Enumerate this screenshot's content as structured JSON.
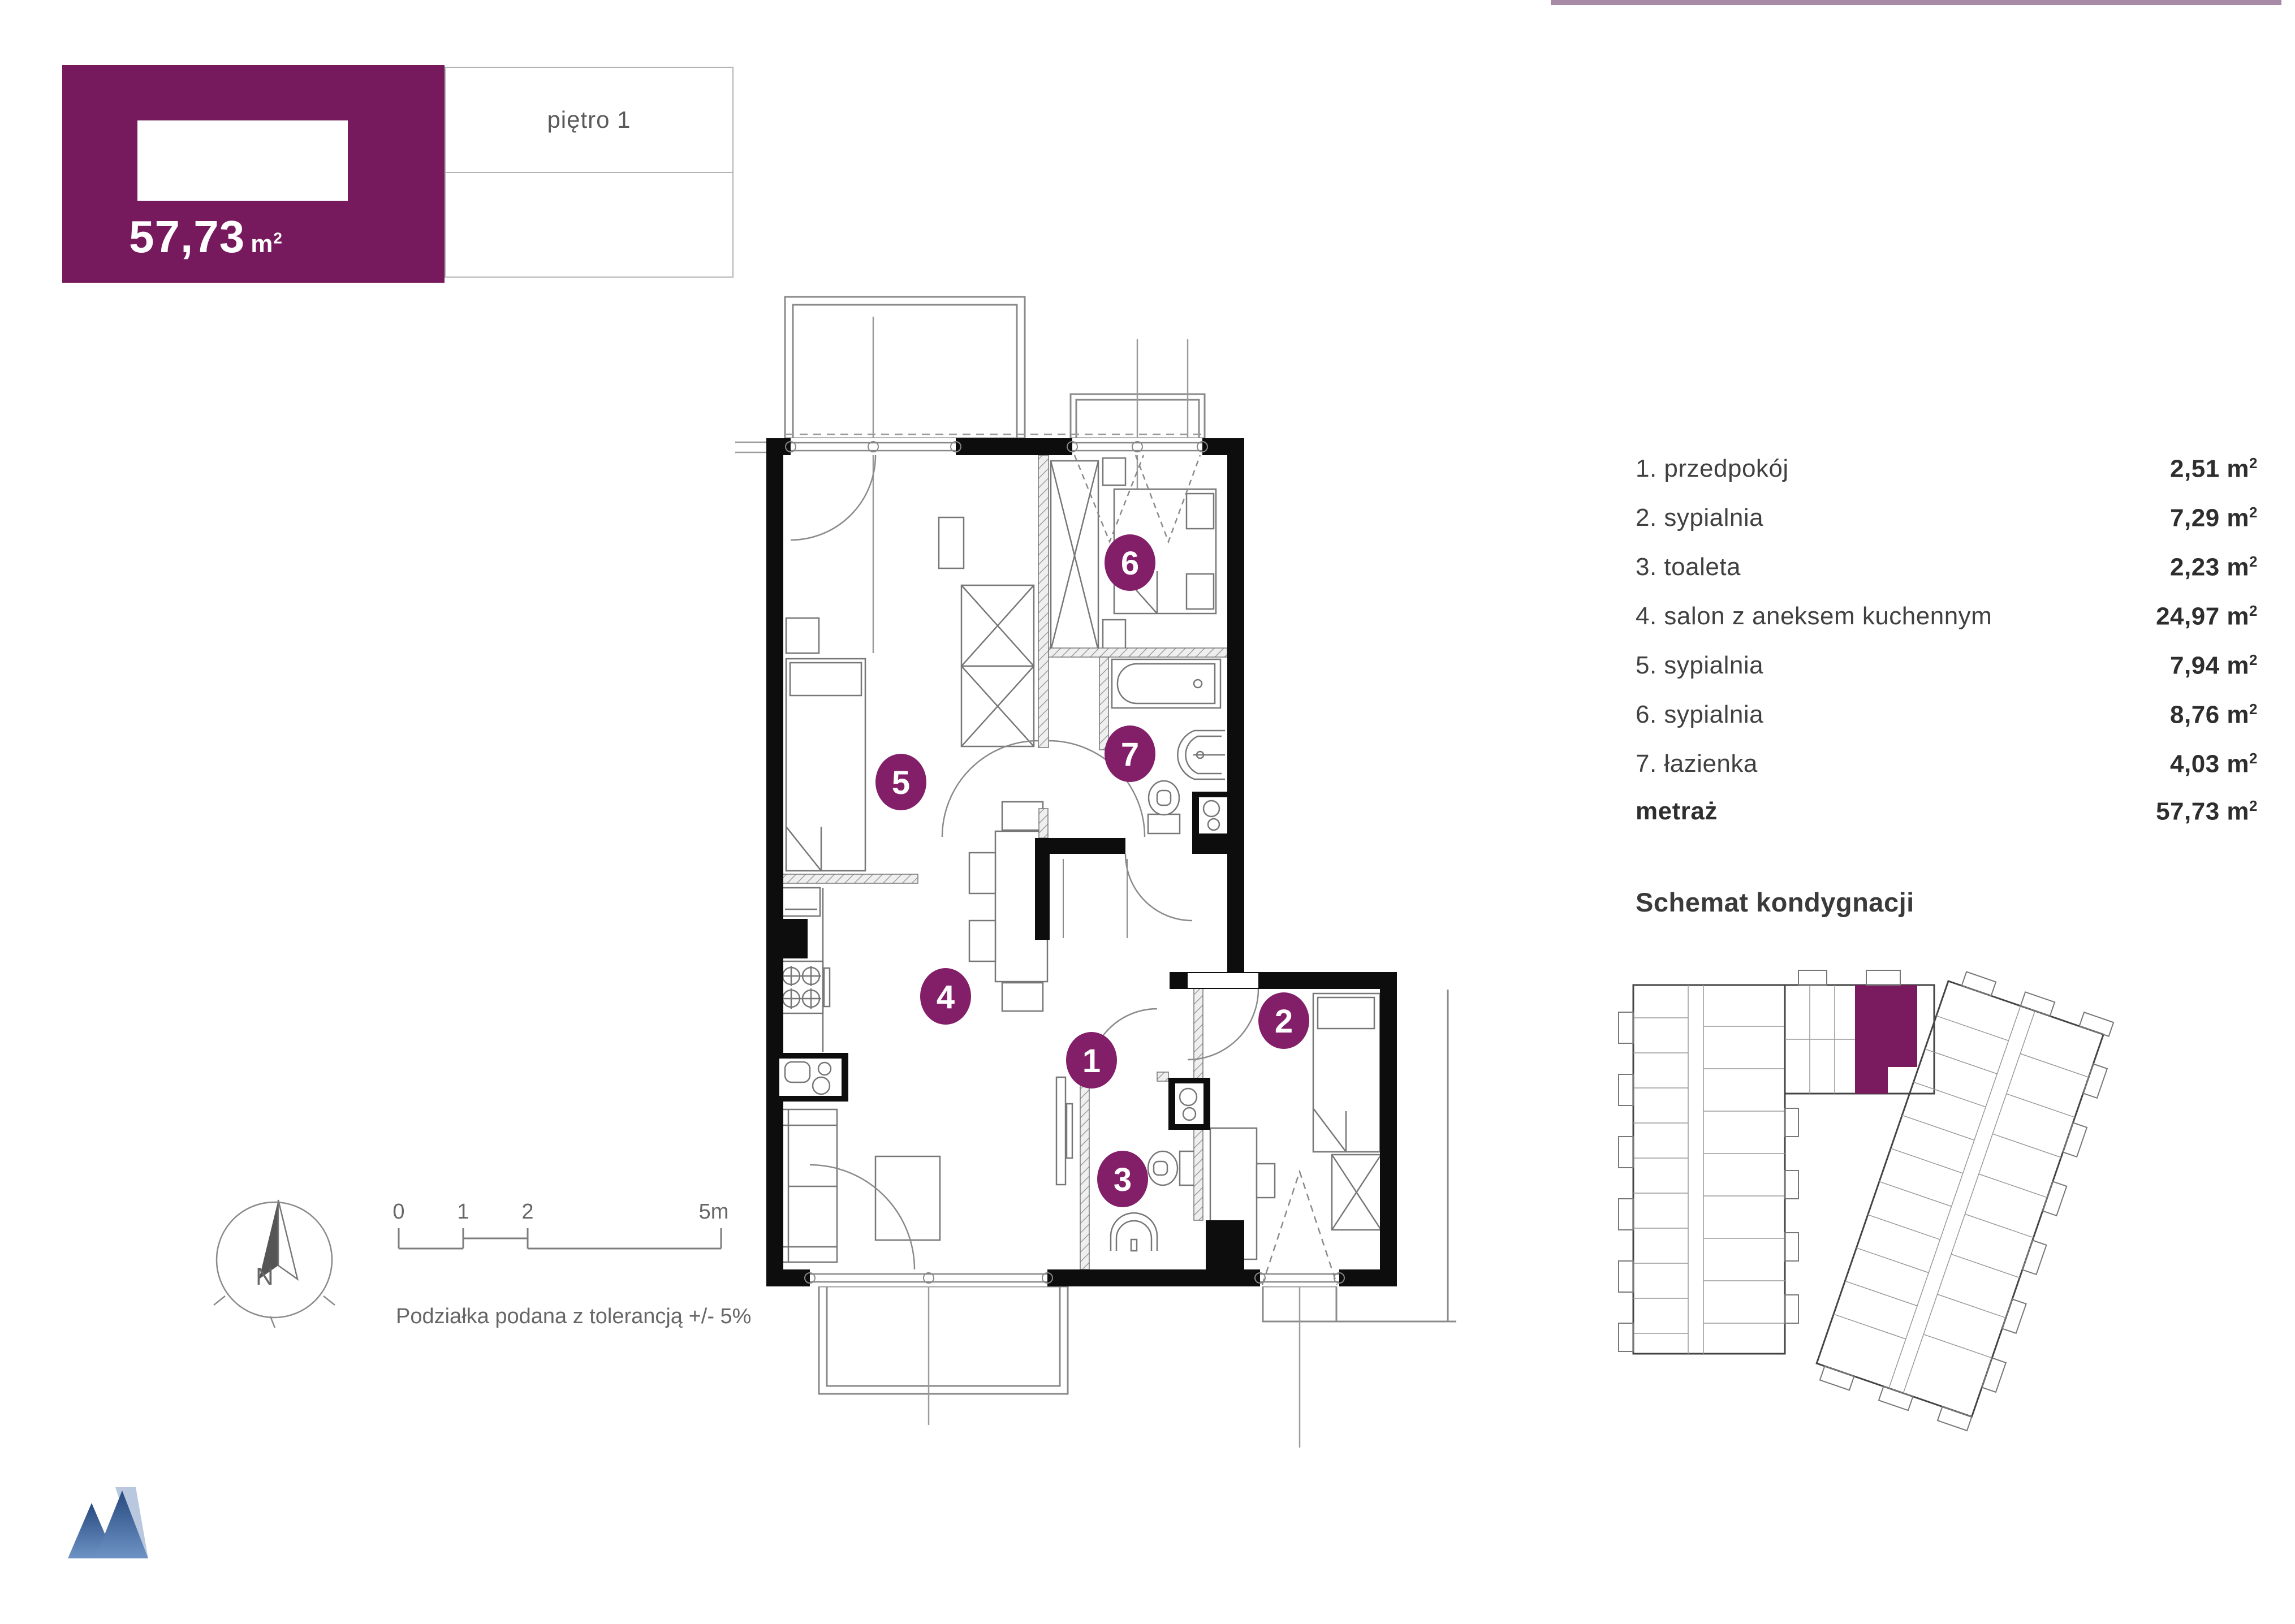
{
  "topbar": {
    "color": "#a78ba6"
  },
  "badge": {
    "area": "57,73",
    "unit_base": "m",
    "unit_sup": "2",
    "floor": "piętro 1",
    "bg_color": "#76195d"
  },
  "list": {
    "rows": [
      {
        "num": "1",
        "label": "1. przedpokój",
        "area": "2,51"
      },
      {
        "num": "2",
        "label": "2. sypialnia",
        "area": "7,29"
      },
      {
        "num": "3",
        "label": "3. toaleta",
        "area": "2,23"
      },
      {
        "num": "4",
        "label": "4. salon z aneksem kuchennym",
        "area": "24,97"
      },
      {
        "num": "5",
        "label": "5. sypialnia",
        "area": "7,94"
      },
      {
        "num": "6",
        "label": "6. sypialnia",
        "area": "8,76"
      },
      {
        "num": "7",
        "label": "7. łazienka",
        "area": "4,03"
      }
    ],
    "total": {
      "label": "metraż",
      "area": "57,73"
    }
  },
  "units": {
    "m": "m",
    "sup": "2"
  },
  "schemat": {
    "title": "Schemat kondygnacji"
  },
  "plan": {
    "marker_color": "#831f69",
    "circles": [
      {
        "n": "1"
      },
      {
        "n": "2"
      },
      {
        "n": "3"
      },
      {
        "n": "4"
      },
      {
        "n": "5"
      },
      {
        "n": "6"
      },
      {
        "n": "7"
      }
    ]
  },
  "compass": {
    "north": "N"
  },
  "scalebar": {
    "t0": "0",
    "t1": "1",
    "t2": "2",
    "t3": "5m",
    "note": "Podziałka podana z tolerancją +/- 5%"
  },
  "logo": {
    "icon": "mountain-logo",
    "color": "#4a72ac"
  }
}
